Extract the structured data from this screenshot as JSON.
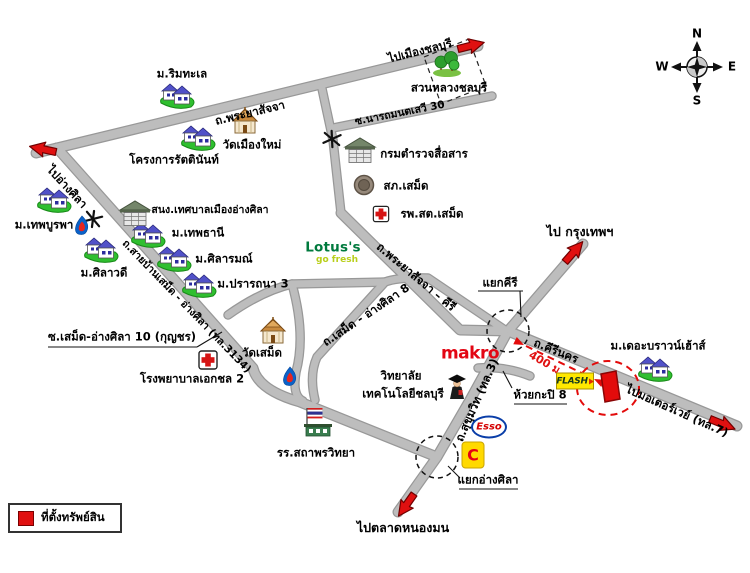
{
  "legend": {
    "property_label": "ที่ตั้งทรัพย์สิน"
  },
  "compass": {
    "n": "N",
    "s": "S",
    "w": "W",
    "e": "E"
  },
  "roads": {
    "phraya_sajja": "ถ.พระยาสัจจา",
    "narthamontasewi": "ซ.นารถมนตเสวี 30",
    "phraya_sajja_kiri": "ถ.พระยาสัจจา – คีรี",
    "samed_angsila_8": "ถ.เสม็ด - อ่างศิลา 8",
    "ban_samed_angsila": "ถ.สายบ้านเสม็ด - อ่างศิลา (ทล.3134)",
    "sukhumvit": "ถ.สุขุมวิท (ทล.3)",
    "kiri_nakhon": "ถ.คีรีนคร",
    "samed_angsila_10": "ซ.เสม็ด-อ่างศิลา 10 (กุญชร)",
    "huai_kapi_8": "ห้วยกะปิ 8"
  },
  "directions": {
    "to_chonburi": "ไปเมืองชลบุรี",
    "to_angsila": "ไปอ่างศิลา",
    "to_bangkok": "ไป กรุงเทพฯ",
    "to_motorway": "ไปมอเตอร์เวย์ (ทล.7)",
    "to_nongmon_market": "ไปตลาดหนองมน"
  },
  "junctions": {
    "kiri": "แยกคีรี",
    "angsila": "แยกอ่างศิลา"
  },
  "annotations": {
    "distance_to_property": "400 ม."
  },
  "places": {
    "rim_talay": "ม.ริมทะเล",
    "rattinan": "โครงการรัตตินันท์",
    "wat_muang_mai": "วัดเมืองใหม่",
    "suan_luang": "สวนหลวงชลบุรี",
    "police_comm": "กรมตำรวจสื่อสาร",
    "samet_police": "สภ.เสม็ด",
    "samet_health": "รพ.สต.เสม็ด",
    "thep_burapha": "ม.เทพบูรพา",
    "municipal": "สนง.เทศบาลเมืองอ่างศิลา",
    "thep_thani": "ม.เทพธานี",
    "silarom": "ม.ศิลารมณ์",
    "silawadee": "ม.ศิลาวดี",
    "prattana": "ม.ปรารถนา 3",
    "aikchol": "โรงพยาบาลเอกชล 2",
    "wat_samet": "วัดเสม็ด",
    "sathaporn": "รร.สถาพรวิทยา",
    "college": {
      "line1": "วิทยาลัย",
      "line2": "เทคโนโลยีชลบุรี"
    },
    "brown_house": "ม.เดอะบราวน์เฮ้าส์"
  },
  "brands": {
    "lotus": {
      "name": "Lotus's",
      "tagline": "go fresh"
    },
    "makro": "makro",
    "esso": "Esso",
    "big_c": "C",
    "flash": "FLASH"
  },
  "colors": {
    "road_fill": "#bdbdbd",
    "road_casing": "#989898",
    "arrow_red": "#e01010",
    "property_red": "#e30b0b",
    "makro_red": "#e30613",
    "lotus_green": "#007a3d",
    "bigc_yellow": "#ffd900",
    "esso_blue": "#0a3ea8"
  }
}
